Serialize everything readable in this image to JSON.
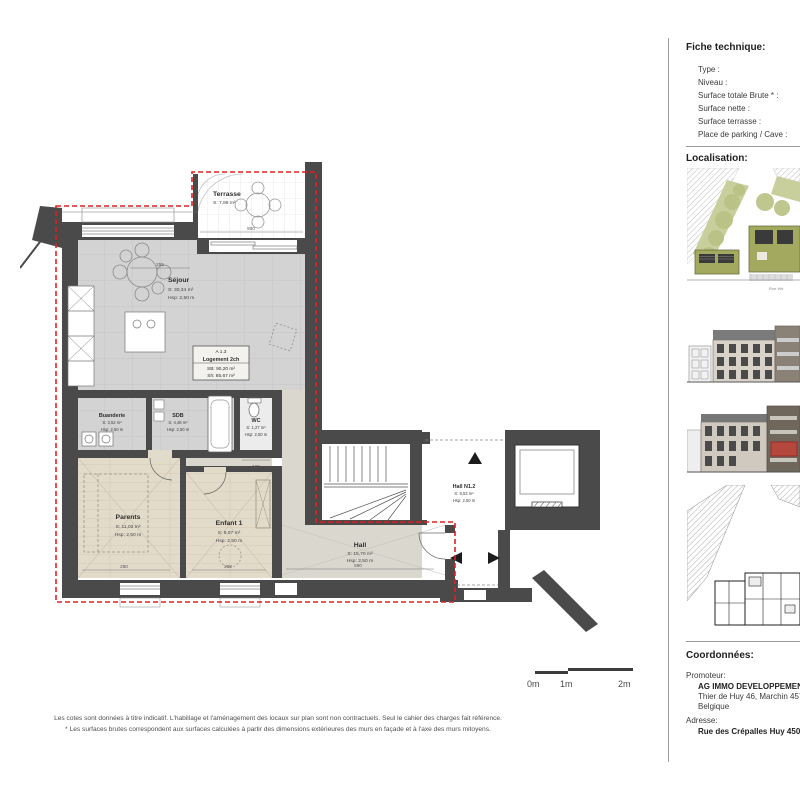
{
  "colors": {
    "wall": "#4a4a4a",
    "boundary_red": "#e02020",
    "highlight_red": "#d23b2f",
    "tile_floor": "#d3d3d3",
    "wood_floor": "#e3dbca",
    "hall_floor": "#dad7cf"
  },
  "fiche": {
    "title": "Fiche technique:",
    "fields": [
      "Type :",
      "Niveau :",
      "Surface totale Brute * :",
      "Surface nette :",
      "Surface terrasse :",
      "Place de parking / Cave :"
    ]
  },
  "localisation": {
    "title": "Localisation:",
    "street_caption": "Rue Wé"
  },
  "coordonnees": {
    "title": "Coordonnées:",
    "promoteur_label": "Promoteur:",
    "promoteur_name": "AG IMMO DEVELOPPEMENT",
    "promoteur_address": "Thier de Huy 46, Marchin 4570",
    "promoteur_country": "Belgique",
    "adresse_label": "Adresse:",
    "adresse_value": "Rue des Crépalles Huy 4500"
  },
  "scale_bar": {
    "labels": [
      "0m",
      "1m",
      "2m"
    ]
  },
  "footnotes": [
    "Les cotes sont données à titre indicatif. L'habillage et l'aménagement des locaux sur plan sont non contractuels. Seul le cahier des charges fait référence.",
    "* Les surfaces brutes correspondent aux surfaces calculées à partir des dimensions extérieures des murs en façade et à l'axe des murs mitoyens."
  ],
  "plan": {
    "unit": {
      "code": "A 1.3",
      "type": "Logement 2ch",
      "sb": "SB: 90,20 m²",
      "sh": "Sh: 85,67 m²"
    },
    "rooms": {
      "terrasse": {
        "name": "Terrasse",
        "area": "S: 7,98 m²"
      },
      "sejour": {
        "name": "Séjour",
        "area": "S: 30,34 m²",
        "hsp": "Hsp: 2,50 m"
      },
      "buanderie": {
        "name": "Buanderie",
        "area": "S: 3,52 m²",
        "hsp": "Hsp: 2,50 m"
      },
      "sdb": {
        "name": "SDB",
        "area": "S: 4,48 m²",
        "hsp": "Hsp: 2,50 m"
      },
      "wc": {
        "name": "WC",
        "area": "S: 1,27 m²",
        "hsp": "Hsp: 2,50 m"
      },
      "parents": {
        "name": "Parents",
        "area": "S: 11,03 m²",
        "hsp": "Hsp: 2,50 m"
      },
      "enfant": {
        "name": "Enfant 1",
        "area": "S: 9,07 m²",
        "hsp": "Hsp: 2,50 m"
      },
      "hall": {
        "name": "Hall",
        "area": "S: 15,70 m²",
        "hsp": "Hsp: 2,50 m"
      },
      "hall_commun": {
        "name": "Hall N1.2",
        "area": "S: 9,53 m²",
        "hsp": "Hsp: 2,50 m"
      }
    },
    "dims": [
      "900",
      "298",
      "255",
      "280",
      "288",
      "590",
      "100"
    ]
  }
}
